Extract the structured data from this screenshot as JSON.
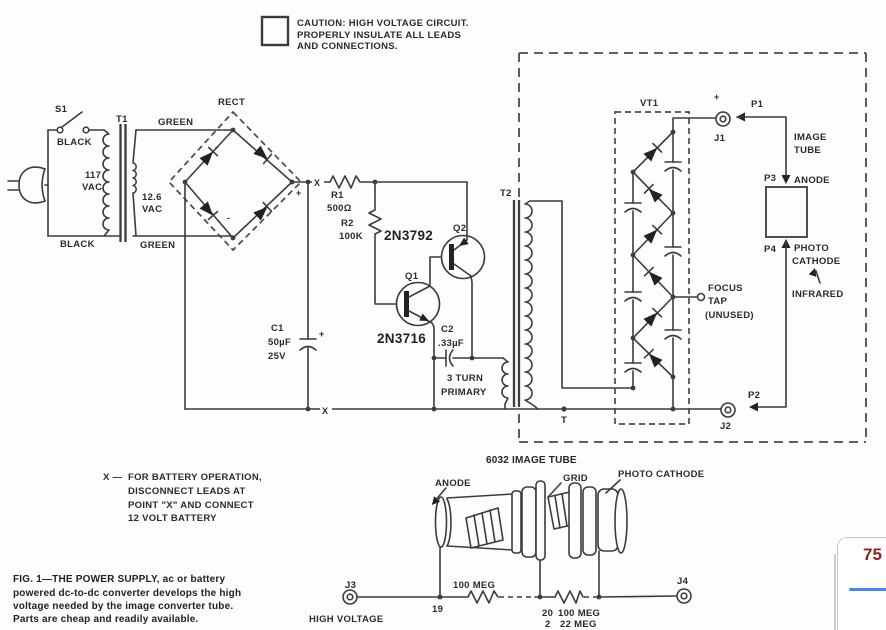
{
  "colors": {
    "ink": "#3c3c3c",
    "text": "#2b2b2b",
    "accent_blue": "#4a86e8",
    "page_number_color": "#8b2424"
  },
  "caution": {
    "lines": [
      "CAUTION:  HIGH VOLTAGE CIRCUIT.",
      "PROPERLY INSULATE ALL LEADS",
      "AND CONNECTIONS."
    ]
  },
  "ac": {
    "s1": "S1",
    "black_top": "BLACK",
    "black_bottom": "BLACK",
    "t1": "T1",
    "v_primary": [
      "117",
      "VAC"
    ],
    "v_secondary": [
      "12.6",
      "VAC"
    ],
    "green_top": "GREEN",
    "green_bottom": "GREEN",
    "rect": "RECT",
    "plus": "+",
    "minus_top": "-",
    "minus_bottom": "-"
  },
  "supply": {
    "x_top": "X",
    "x_bottom": "X",
    "c1": [
      "C1",
      "50µF",
      "25V"
    ],
    "c1_plus": "+",
    "r1": [
      "R1",
      "500Ω"
    ],
    "r2": [
      "R2",
      "100K"
    ]
  },
  "osc": {
    "q1": "Q1",
    "q1_part": "2N3716",
    "q2": "Q2",
    "q2_part": "2N3792",
    "c2": [
      "C2",
      ".33µF"
    ],
    "winding": [
      "3 TURN",
      "PRIMARY"
    ]
  },
  "hv": {
    "t2": "T2",
    "tap": "T",
    "vt1": "VT1",
    "focus": [
      "FOCUS",
      "TAP",
      "(UNUSED)"
    ],
    "j1": "J1",
    "j1_polarity": "+",
    "p1": "P1",
    "image_tube": [
      "IMAGE",
      "TUBE"
    ],
    "p3": "P3",
    "anode": "ANODE",
    "p4": "P4",
    "photo": [
      "PHOTO",
      "CATHODE"
    ],
    "infrared": "INFRARED",
    "p2": "P2",
    "j2": "J2"
  },
  "pictorial": {
    "title": "6032 IMAGE TUBE",
    "anode": "ANODE",
    "grid": "GRID",
    "cathode": "PHOTO CATHODE"
  },
  "divider": {
    "j3": "J3",
    "high_voltage": "HIGH VOLTAGE",
    "pin19": "19",
    "res1": "100 MEG",
    "pin20": "20",
    "res2": "100 MEG",
    "pin2": "2",
    "res3": "22 MEG",
    "j4": "J4"
  },
  "note": {
    "prefix": "X —",
    "lines": [
      "FOR BATTERY OPERATION,",
      "DISCONNECT LEADS AT",
      "POINT \"X\" AND CONNECT",
      "12 VOLT BATTERY"
    ]
  },
  "caption": {
    "lines": [
      "FIG. 1—THE POWER SUPPLY, ac or battery",
      "powered dc-to-dc converter develops the high",
      "voltage needed by the image converter tube.",
      "Parts are cheap and readily available."
    ]
  },
  "overlay": {
    "page": "75"
  }
}
